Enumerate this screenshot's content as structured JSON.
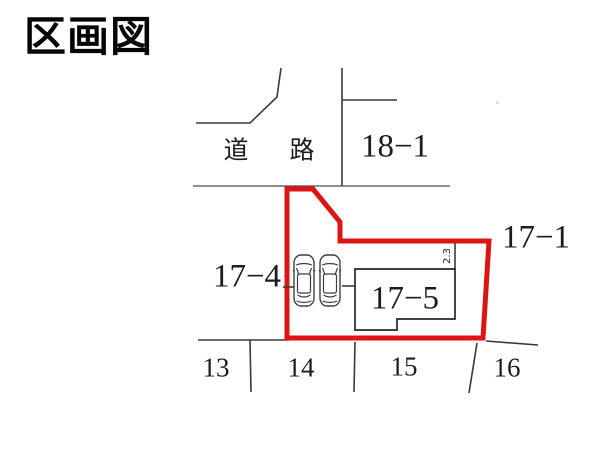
{
  "title": "区画図",
  "road": {
    "label_left": "道",
    "label_right": "路"
  },
  "parcels": {
    "p18_1": "18−1",
    "p17_1": "17−1",
    "p17_4": "17−4",
    "p17_5": "17−5",
    "p13": "13",
    "p14": "14",
    "p15": "15",
    "p16": "16"
  },
  "dimensions": {
    "setback": "2.3"
  },
  "icons": {
    "car": "car-icon",
    "car_count": 2
  },
  "colors": {
    "boundary": "#de1414",
    "line": "#3a3a3a",
    "text": "#1c1c1c"
  }
}
